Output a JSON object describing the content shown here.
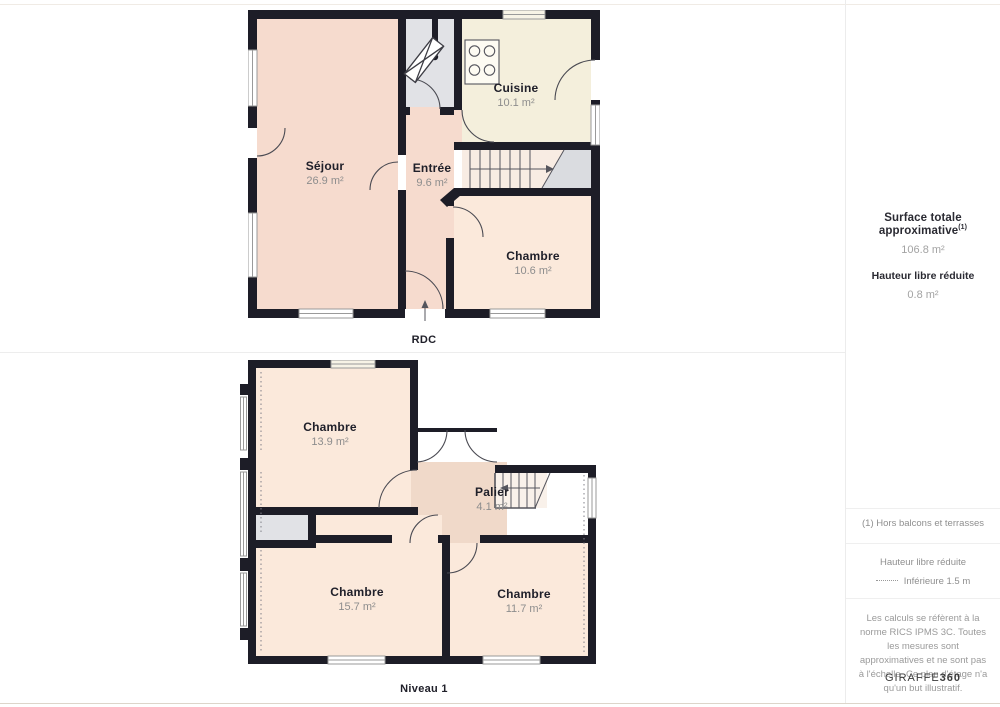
{
  "floors": [
    {
      "label": "RDC",
      "rooms": [
        {
          "name": "Séjour",
          "area": "26.9 m²"
        },
        {
          "name": "Entrée",
          "area": "9.6 m²"
        },
        {
          "name": "Cuisine",
          "area": "10.1 m²"
        },
        {
          "name": "Chambre",
          "area": "10.6 m²"
        }
      ]
    },
    {
      "label": "Niveau 1",
      "rooms": [
        {
          "name": "Chambre",
          "area": "13.9 m²"
        },
        {
          "name": "Palier",
          "area": "4.1 m²"
        },
        {
          "name": "Chambre",
          "area": "15.7 m²"
        },
        {
          "name": "Chambre",
          "area": "11.7 m²"
        }
      ]
    }
  ],
  "sidebar": {
    "surface_label": "Surface totale approximative",
    "surface_sup": "(1)",
    "surface_value": "106.8 m²",
    "height_label": "Hauteur libre réduite",
    "height_value": "0.8 m²",
    "footnote": "(1) Hors balcons et terrasses",
    "legend_title": "Hauteur libre réduite",
    "legend_item": "Inférieure 1.5 m",
    "disclaimer": "Les calculs se réfèrent à la norme RICS IPMS 3C. Toutes les mesures sont approximatives et ne sont pas à l'échelle. Ce plan d'étage n'a qu'un but illustratif.",
    "brand_normal": "GIRAFFE",
    "brand_bold": "360"
  },
  "colors": {
    "wall": "#1d1d27",
    "room_pink": "#f6dbce",
    "room_peach": "#fbe9db",
    "room_cream": "#f4efdc",
    "room_salmon": "#f0d9c9",
    "room_gray": "#e1e2e6",
    "landing_gray": "#dadce0"
  }
}
